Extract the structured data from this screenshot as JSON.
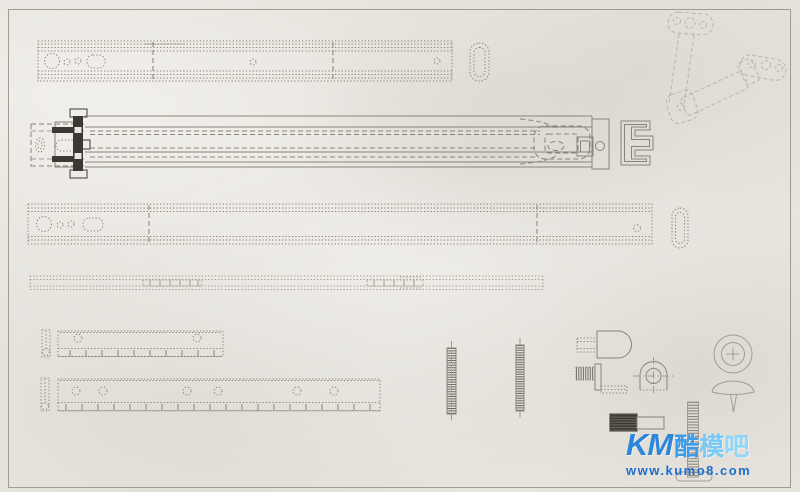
{
  "watermark": {
    "line1": [
      {
        "text": "KM",
        "color": "#2e86da"
      },
      {
        "text": "酷",
        "color": "#3d9ce5"
      },
      {
        "text": "模",
        "color": "#79c9f5"
      },
      {
        "text": "吧",
        "color": "#8fd6f9"
      }
    ],
    "url": {
      "text": "www.kumo8.com",
      "color": "#1d6ed3"
    }
  },
  "theme": {
    "paper": "#e9e6e0",
    "frame": "#a19c90",
    "line": "#8a8478",
    "line_faint": "#a29c8f",
    "line_dark": "#3a3934"
  }
}
